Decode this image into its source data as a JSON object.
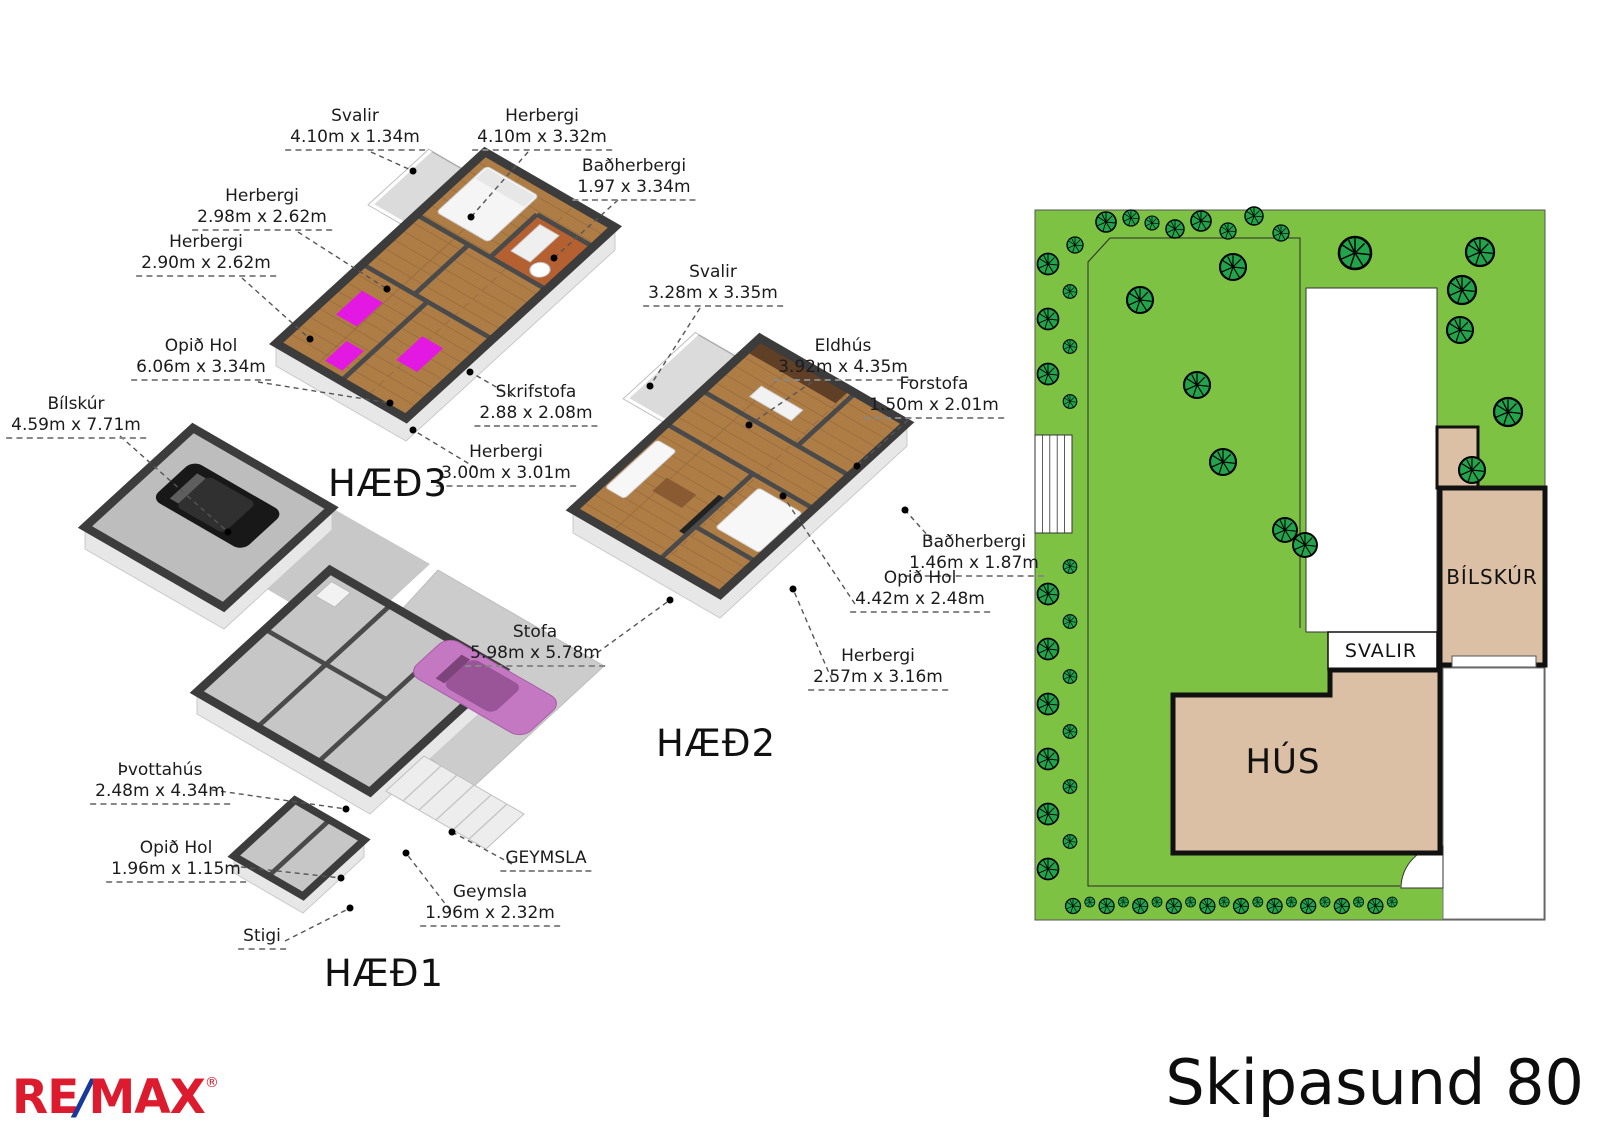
{
  "page_title": "Skipasund 80",
  "logo": {
    "re": "RE",
    "slash": "/",
    "max": "MAX",
    "reg": "®"
  },
  "floors": [
    {
      "name": "HÆÐ1",
      "labels": [
        {
          "room": "Bílskúr",
          "dims": "4.59m x 7.71m"
        },
        {
          "room": "Þvottahús",
          "dims": "2.48m x 4.34m"
        },
        {
          "room": "Opið Hol",
          "dims": "1.96m x 1.15m"
        },
        {
          "room": "Stigi",
          "dims": ""
        },
        {
          "room": "GEYMSLA",
          "dims": ""
        },
        {
          "room": "Geymsla",
          "dims": "1.96m x 2.32m"
        }
      ]
    },
    {
      "name": "HÆÐ2",
      "labels": [
        {
          "room": "Svalir",
          "dims": "3.28m x 3.35m"
        },
        {
          "room": "Eldhús",
          "dims": "3.92m x 4.35m"
        },
        {
          "room": "Forstofa",
          "dims": "1.50m x 2.01m"
        },
        {
          "room": "Baðherbergi",
          "dims": "1.46m x 1.87m"
        },
        {
          "room": "Opið Hol",
          "dims": "4.42m x 2.48m"
        },
        {
          "room": "Herbergi",
          "dims": "2.57m x 3.16m"
        },
        {
          "room": "Stofa",
          "dims": "5.98m x 5.78m"
        }
      ]
    },
    {
      "name": "HÆÐ3",
      "labels": [
        {
          "room": "Svalir",
          "dims": "4.10m x 1.34m"
        },
        {
          "room": "Herbergi",
          "dims": "4.10m x 3.32m"
        },
        {
          "room": "Baðherbergi",
          "dims": "1.97 x 3.34m"
        },
        {
          "room": "Herbergi",
          "dims": "2.98m x 2.62m"
        },
        {
          "room": "Herbergi",
          "dims": "2.90m x 2.62m"
        },
        {
          "room": "Opið Hol",
          "dims": "6.06m x 3.34m"
        },
        {
          "room": "Skrifstofa",
          "dims": "2.88 x 2.08m"
        },
        {
          "room": "Herbergi",
          "dims": "3.00m x 3.01m"
        }
      ]
    }
  ],
  "siteplan": {
    "hus_label": "HÚS",
    "bilskur_label": "BÍLSKÚR",
    "svalir_label": "SVALIR"
  },
  "colors": {
    "lawn": "#7DC242",
    "tree": "#21A44B",
    "building": "#DCC0A5",
    "wood": "#AE7D46",
    "remax_red": "#DC1C2E",
    "remax_blue": "#16399E"
  }
}
